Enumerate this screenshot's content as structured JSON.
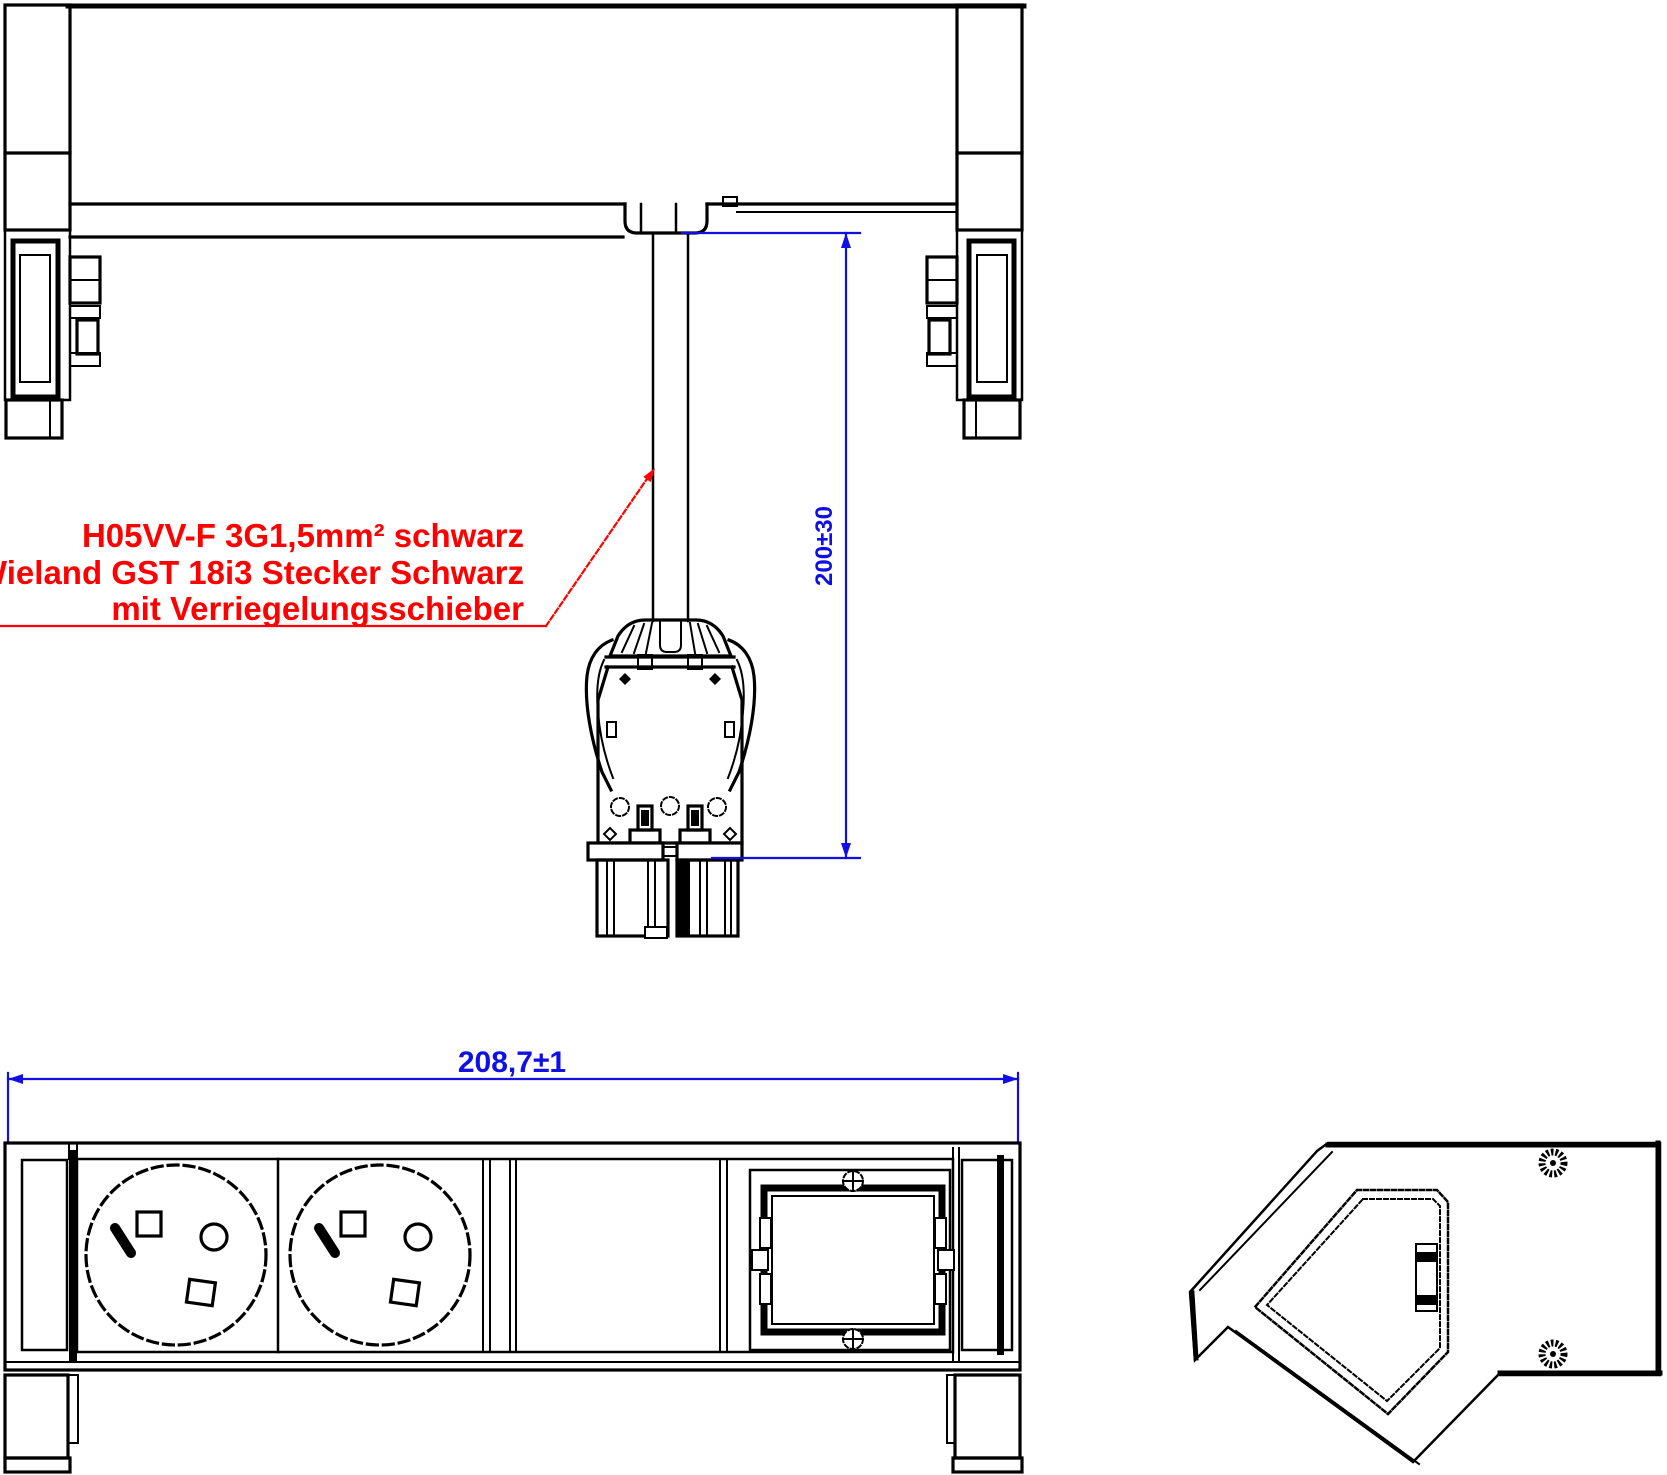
{
  "annotation": {
    "line1": "H05VV-F 3G1,5mm² schwarz",
    "line2": "Wieland GST 18i3 Stecker Schwarz",
    "line3": "mit Verriegelungsschieber"
  },
  "dimensions": {
    "cable_length": "200±30",
    "unit_width": "208,7±1"
  },
  "colors": {
    "drawing_lines": "#000000",
    "dimension": "#0f0fe6",
    "annotation": "#ff0000",
    "background": "#ffffff"
  }
}
